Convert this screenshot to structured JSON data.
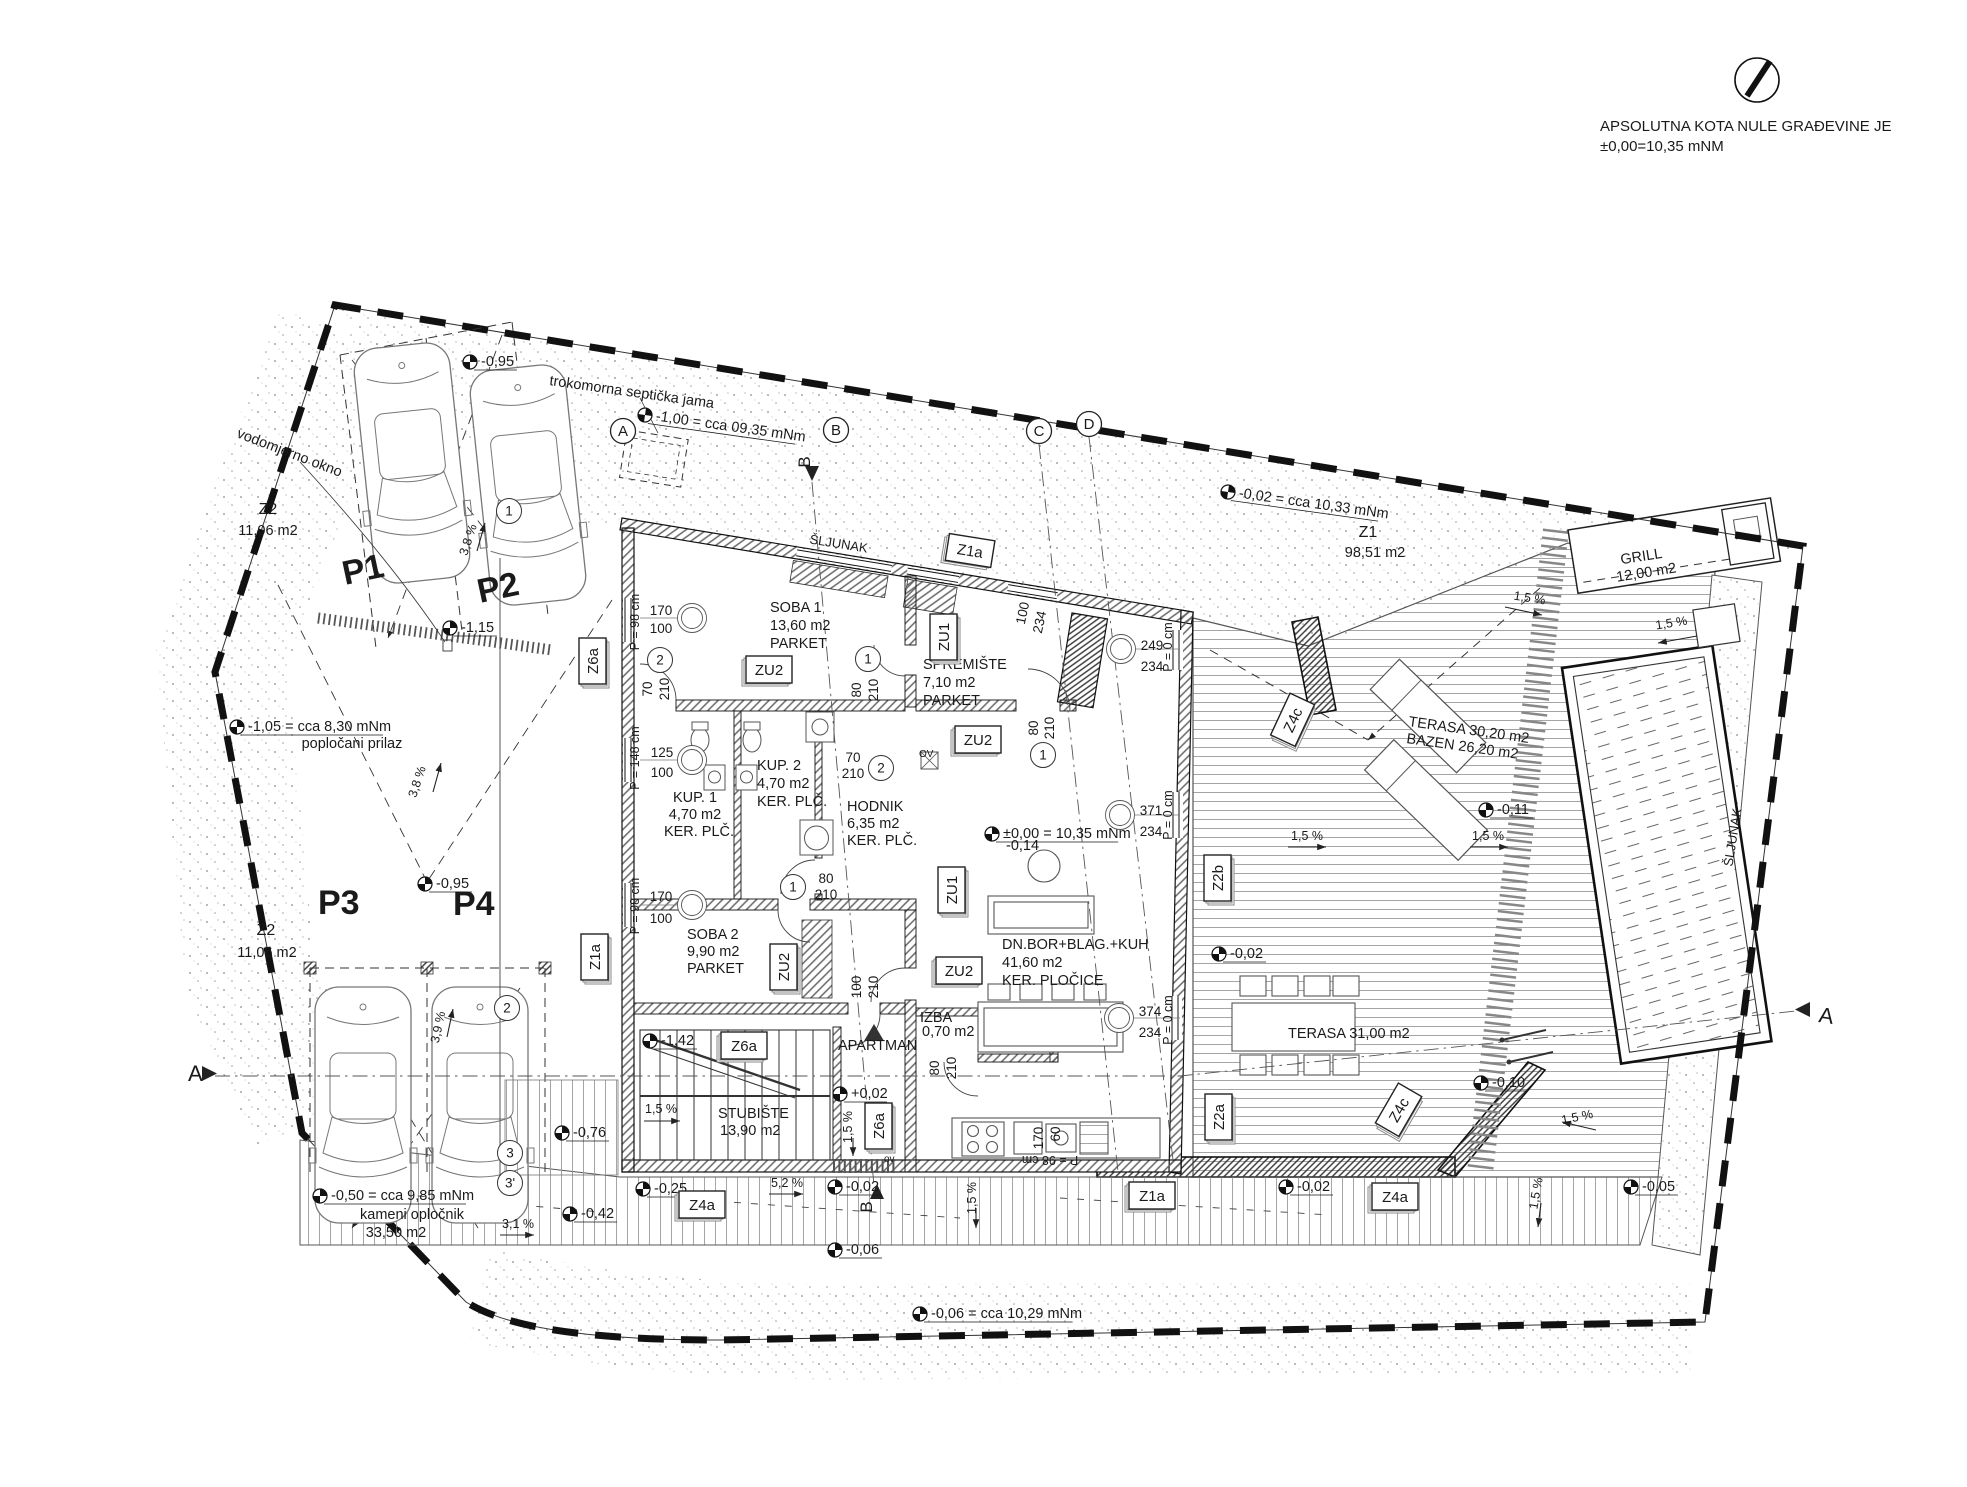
{
  "header": {
    "line1": "APSOLUTNA KOTA NULE GRAĐEVINE JE",
    "line2": "±0,00=10,35 mNM"
  },
  "labels": [
    {
      "t": "trokomorna septička jama",
      "x": 549,
      "y": 385,
      "r": 8
    },
    {
      "t": "vodomjerno okno",
      "x": 236,
      "y": 437,
      "r": 21
    },
    {
      "t": "Z2",
      "x": 268,
      "y": 514,
      "a": "m",
      "s": 16
    },
    {
      "t": "11,06 m2",
      "x": 268,
      "y": 535,
      "a": "m"
    },
    {
      "t": "Z2",
      "x": 266,
      "y": 935,
      "a": "m",
      "s": 16
    },
    {
      "t": "11,06 m2",
      "x": 267,
      "y": 957,
      "a": "m"
    },
    {
      "t": "Z1",
      "x": 1368,
      "y": 537,
      "a": "m",
      "s": 16
    },
    {
      "t": "98,51 m2",
      "x": 1375,
      "y": 557,
      "a": "m"
    },
    {
      "t": "popločani prilaz",
      "x": 352,
      "y": 748,
      "a": "m"
    },
    {
      "t": "kameni opločnik",
      "x": 412,
      "y": 1219,
      "a": "m"
    },
    {
      "t": "33,50 m2",
      "x": 396,
      "y": 1237,
      "a": "m"
    },
    {
      "t": "P1",
      "x": 345,
      "y": 585,
      "r": -12,
      "s": 34,
      "w": "b",
      "c": "#b4b4b4"
    },
    {
      "t": "P2",
      "x": 480,
      "y": 603,
      "r": -12,
      "s": 34,
      "w": "b",
      "c": "#b4b4b4"
    },
    {
      "t": "P3",
      "x": 318,
      "y": 914,
      "s": 34,
      "w": "b",
      "c": "#b4b4b4"
    },
    {
      "t": "P4",
      "x": 453,
      "y": 915,
      "s": 34,
      "w": "b",
      "c": "#b4b4b4"
    },
    {
      "t": "ŠLJUNAK",
      "x": 838,
      "y": 548,
      "a": "m",
      "r": 9,
      "s": 13
    },
    {
      "t": "ŠLJUNAK",
      "x": 1737,
      "y": 838,
      "a": "m",
      "r": -81,
      "s": 13
    },
    {
      "t": "GRILL",
      "x": 1642,
      "y": 561,
      "a": "m",
      "r": -9
    },
    {
      "t": "12,00 m2",
      "x": 1647,
      "y": 577,
      "a": "m",
      "r": -9
    },
    {
      "t": "TERASA 30,20 m2",
      "x": 1408,
      "y": 726,
      "r": 8
    },
    {
      "t": "BAZEN 26,20 m2",
      "x": 1406,
      "y": 743,
      "r": 8
    },
    {
      "t": "TERASA 31,00 m2",
      "x": 1288,
      "y": 1038
    },
    {
      "t": "SOBA 1",
      "x": 770,
      "y": 612
    },
    {
      "t": "13,60 m2",
      "x": 770,
      "y": 630
    },
    {
      "t": "PARKET",
      "x": 770,
      "y": 648
    },
    {
      "t": "SPREMIŠTE",
      "x": 923,
      "y": 669
    },
    {
      "t": "7,10 m2",
      "x": 923,
      "y": 687
    },
    {
      "t": "PARKET",
      "x": 923,
      "y": 705
    },
    {
      "t": "KUP. 1",
      "x": 695,
      "y": 802,
      "a": "m"
    },
    {
      "t": "4,70 m2",
      "x": 695,
      "y": 819,
      "a": "m"
    },
    {
      "t": "KER. PLČ.",
      "x": 699,
      "y": 836,
      "a": "m"
    },
    {
      "t": "KUP. 2",
      "x": 757,
      "y": 770
    },
    {
      "t": "4,70 m2",
      "x": 757,
      "y": 788
    },
    {
      "t": "KER. PLČ.",
      "x": 757,
      "y": 806
    },
    {
      "t": "HODNIK",
      "x": 847,
      "y": 811
    },
    {
      "t": "6,35 m2",
      "x": 847,
      "y": 828
    },
    {
      "t": "KER. PLČ.",
      "x": 847,
      "y": 845
    },
    {
      "t": "SOBA 2",
      "x": 687,
      "y": 939
    },
    {
      "t": "9,90 m2",
      "x": 687,
      "y": 956
    },
    {
      "t": "PARKET",
      "x": 687,
      "y": 973
    },
    {
      "t": "STUBIŠTE",
      "x": 718,
      "y": 1118
    },
    {
      "t": "13,90 m2",
      "x": 720,
      "y": 1135
    },
    {
      "t": "APARTMAN",
      "x": 838,
      "y": 1050
    },
    {
      "t": "IZBA",
      "x": 920,
      "y": 1022
    },
    {
      "t": "0,70 m2",
      "x": 922,
      "y": 1036
    },
    {
      "t": "DN.BOR+BLAG.+KUH",
      "x": 1002,
      "y": 949
    },
    {
      "t": "41,60 m2",
      "x": 1002,
      "y": 967
    },
    {
      "t": "KER. PLOČICE",
      "x": 1002,
      "y": 985
    },
    {
      "t": "-0,14",
      "x": 1006,
      "y": 850
    },
    {
      "t": "OV",
      "x": 919,
      "y": 757,
      "s": 10
    },
    {
      "t": "ov",
      "x": 884,
      "y": 1162,
      "s": 10
    },
    {
      "t": "170",
      "x": 661,
      "y": 615,
      "a": "m",
      "s": 13.5
    },
    {
      "t": "100",
      "x": 661,
      "y": 633,
      "a": "m",
      "s": 13.5
    },
    {
      "t": "P = 98 cm",
      "x": 639,
      "y": 622,
      "r": -90,
      "a": "m",
      "s": 12.5
    },
    {
      "t": "125",
      "x": 662,
      "y": 757,
      "a": "m",
      "s": 13.5
    },
    {
      "t": "100",
      "x": 662,
      "y": 777,
      "a": "m",
      "s": 13.5
    },
    {
      "t": "P = 148 cm",
      "x": 639,
      "y": 758,
      "r": -90,
      "a": "m",
      "s": 12.5
    },
    {
      "t": "170",
      "x": 661,
      "y": 901,
      "a": "m",
      "s": 13.5
    },
    {
      "t": "100",
      "x": 661,
      "y": 923,
      "a": "m",
      "s": 13.5
    },
    {
      "t": "P = 98 cm",
      "x": 639,
      "y": 906,
      "r": -90,
      "a": "m",
      "s": 12.5
    },
    {
      "t": "70",
      "x": 652,
      "y": 689,
      "r": -90,
      "a": "m",
      "s": 13.5
    },
    {
      "t": "210",
      "x": 669,
      "y": 689,
      "r": -90,
      "a": "m",
      "s": 13.5
    },
    {
      "t": "80",
      "x": 861,
      "y": 690,
      "r": -90,
      "a": "m",
      "s": 13.5
    },
    {
      "t": "210",
      "x": 878,
      "y": 690,
      "r": -90,
      "a": "m",
      "s": 13.5
    },
    {
      "t": "70",
      "x": 853,
      "y": 762,
      "a": "m",
      "s": 13.5
    },
    {
      "t": "210",
      "x": 853,
      "y": 778,
      "a": "m",
      "s": 13.5
    },
    {
      "t": "80",
      "x": 826,
      "y": 883,
      "a": "m",
      "s": 13.5
    },
    {
      "t": "210",
      "x": 826,
      "y": 899,
      "a": "m",
      "s": 13.5
    },
    {
      "t": "100",
      "x": 861,
      "y": 987,
      "r": -90,
      "a": "m",
      "s": 13.5
    },
    {
      "t": "210",
      "x": 878,
      "y": 987,
      "r": -90,
      "a": "m",
      "s": 13.5
    },
    {
      "t": "80",
      "x": 939,
      "y": 1068,
      "r": -90,
      "a": "m",
      "s": 13.5
    },
    {
      "t": "210",
      "x": 956,
      "y": 1068,
      "r": -90,
      "a": "m",
      "s": 13.5
    },
    {
      "t": "80",
      "x": 1038,
      "y": 728,
      "r": -90,
      "a": "m",
      "s": 13.5
    },
    {
      "t": "210",
      "x": 1054,
      "y": 728,
      "r": -90,
      "a": "m",
      "s": 13.5
    },
    {
      "t": "100",
      "x": 1027,
      "y": 614,
      "r": -78,
      "a": "m",
      "s": 13.5
    },
    {
      "t": "234",
      "x": 1044,
      "y": 623,
      "r": -78,
      "a": "m",
      "s": 13.5
    },
    {
      "t": "249",
      "x": 1152,
      "y": 650,
      "a": "m",
      "s": 13.5
    },
    {
      "t": "234",
      "x": 1152,
      "y": 671,
      "a": "m",
      "s": 13.5
    },
    {
      "t": "P = 0 cm",
      "x": 1172,
      "y": 647,
      "r": -90,
      "a": "m",
      "s": 12.5
    },
    {
      "t": "371",
      "x": 1151,
      "y": 815,
      "a": "m",
      "s": 13.5
    },
    {
      "t": "234",
      "x": 1151,
      "y": 836,
      "a": "m",
      "s": 13.5
    },
    {
      "t": "P = 0 cm",
      "x": 1172,
      "y": 815,
      "r": -90,
      "a": "m",
      "s": 12.5
    },
    {
      "t": "374",
      "x": 1150,
      "y": 1016,
      "a": "m",
      "s": 13.5
    },
    {
      "t": "234",
      "x": 1150,
      "y": 1037,
      "a": "m",
      "s": 13.5
    },
    {
      "t": "P = 0 cm",
      "x": 1172,
      "y": 1020,
      "r": -90,
      "a": "m",
      "s": 12.5
    },
    {
      "t": "170",
      "x": 1043,
      "y": 1138,
      "r": -90,
      "a": "m",
      "s": 13.5
    },
    {
      "t": "60",
      "x": 1060,
      "y": 1134,
      "r": -90,
      "a": "m",
      "s": 13.5
    },
    {
      "t": "P = 98 cm",
      "x": 1050,
      "y": 1156,
      "r": 180,
      "a": "m",
      "s": 12.5
    },
    {
      "t": "3,8 %",
      "x": 472,
      "y": 541,
      "r": -72,
      "a": "m",
      "s": 12.5
    },
    {
      "t": "3,8 %",
      "x": 421,
      "y": 783,
      "r": -72,
      "a": "m",
      "s": 12.5
    },
    {
      "t": "3,9 %",
      "x": 442,
      "y": 1028,
      "r": -78,
      "a": "m",
      "s": 12.5
    },
    {
      "t": "1,5 %",
      "x": 1529,
      "y": 602,
      "r": 9,
      "a": "m",
      "s": 12.5
    },
    {
      "t": "1,5 %",
      "x": 1672,
      "y": 627,
      "r": -9,
      "a": "m",
      "s": 12.5
    },
    {
      "t": "1,5 %",
      "x": 1307,
      "y": 840,
      "a": "m",
      "s": 12.5
    },
    {
      "t": "1,5 %",
      "x": 1488,
      "y": 840,
      "a": "m",
      "s": 12.5
    },
    {
      "t": "1,5 %",
      "x": 661,
      "y": 1113,
      "a": "m",
      "s": 12.5
    },
    {
      "t": "1,5 %",
      "x": 852,
      "y": 1127,
      "r": -90,
      "a": "m",
      "s": 12.5
    },
    {
      "t": "1,5 %",
      "x": 976,
      "y": 1198,
      "r": -90,
      "a": "m",
      "s": 12.5
    },
    {
      "t": "1,5 %",
      "x": 1540,
      "y": 1194,
      "r": -80,
      "a": "m",
      "s": 12.5
    },
    {
      "t": "1,5 %",
      "x": 1578,
      "y": 1121,
      "r": -12,
      "a": "m",
      "s": 12.5
    },
    {
      "t": "3,1 %",
      "x": 518,
      "y": 1228,
      "a": "m",
      "s": 12.5
    },
    {
      "t": "5,2 %",
      "x": 787,
      "y": 1187,
      "a": "m",
      "s": 12.5
    },
    {
      "t": "A",
      "x": 188,
      "y": 1081,
      "s": 22
    },
    {
      "t": "A",
      "x": 1818,
      "y": 1022,
      "s": 22,
      "r": 8
    },
    {
      "t": "B",
      "x": 810,
      "y": 462,
      "r": -90,
      "s": 17,
      "a": "m"
    },
    {
      "t": "B",
      "x": 872,
      "y": 1207,
      "r": -90,
      "s": 17,
      "a": "m"
    }
  ],
  "elevations": [
    {
      "t": "-0,95",
      "x": 470,
      "y": 362
    },
    {
      "t": "-1,00 = cca 09,35 mNm",
      "x": 645,
      "y": 415,
      "r": 8
    },
    {
      "t": "-1,15",
      "x": 450,
      "y": 628
    },
    {
      "t": "-1,05 = cca 8,30 mNm",
      "x": 237,
      "y": 727
    },
    {
      "t": "-0,95",
      "x": 425,
      "y": 884
    },
    {
      "t": "-0,02 = cca 10,33 mNm",
      "x": 1228,
      "y": 492,
      "r": 8
    },
    {
      "t": "±0,00 = 10,35 mNm",
      "x": 992,
      "y": 834
    },
    {
      "t": "-0,02",
      "x": 1219,
      "y": 954
    },
    {
      "t": "-0,11",
      "x": 1486,
      "y": 810
    },
    {
      "t": "-1,42",
      "x": 650,
      "y": 1041
    },
    {
      "t": "+0,02",
      "x": 840,
      "y": 1094
    },
    {
      "t": "-0,76",
      "x": 562,
      "y": 1133
    },
    {
      "t": "-0,50 = cca 9,85 mNm",
      "x": 320,
      "y": 1196
    },
    {
      "t": "-0,42",
      "x": 570,
      "y": 1214
    },
    {
      "t": "-0,25",
      "x": 643,
      "y": 1189
    },
    {
      "t": "-0,02",
      "x": 835,
      "y": 1187
    },
    {
      "t": "-0,02",
      "x": 1286,
      "y": 1187
    },
    {
      "t": "-0,06",
      "x": 835,
      "y": 1250
    },
    {
      "t": "-0,06 = cca 10,29 mNm",
      "x": 920,
      "y": 1314
    },
    {
      "t": "-0,10",
      "x": 1481,
      "y": 1083
    },
    {
      "t": "-0,05",
      "x": 1631,
      "y": 1187
    }
  ],
  "tags": [
    {
      "t": "Z1a",
      "x": 970,
      "y": 551,
      "r": 9
    },
    {
      "t": "Z6a",
      "x": 593,
      "y": 661,
      "r": -90
    },
    {
      "t": "Z1a",
      "x": 595,
      "y": 957,
      "r": -90
    },
    {
      "t": "ZU2",
      "x": 769,
      "y": 670
    },
    {
      "t": "ZU1",
      "x": 944,
      "y": 637,
      "r": -90
    },
    {
      "t": "ZU2",
      "x": 978,
      "y": 740
    },
    {
      "t": "ZU1",
      "x": 952,
      "y": 890,
      "r": -90
    },
    {
      "t": "ZU2",
      "x": 784,
      "y": 967,
      "r": -90
    },
    {
      "t": "ZU2",
      "x": 959,
      "y": 971
    },
    {
      "t": "Z6a",
      "x": 744,
      "y": 1046
    },
    {
      "t": "Z6a",
      "x": 879,
      "y": 1126,
      "r": -90
    },
    {
      "t": "Z4a",
      "x": 702,
      "y": 1205
    },
    {
      "t": "Z1a",
      "x": 1152,
      "y": 1196
    },
    {
      "t": "Z2b",
      "x": 1218,
      "y": 878,
      "r": -90
    },
    {
      "t": "Z2a",
      "x": 1219,
      "y": 1117,
      "r": -90
    },
    {
      "t": "Z4c",
      "x": 1293,
      "y": 720,
      "r": -65
    },
    {
      "t": "Z4c",
      "x": 1399,
      "y": 1110,
      "r": -60
    },
    {
      "t": "Z4a",
      "x": 1395,
      "y": 1197
    }
  ],
  "sections": [
    {
      "t": "A",
      "x": 623,
      "y": 431
    },
    {
      "t": "B",
      "x": 836,
      "y": 430
    },
    {
      "t": "C",
      "x": 1039,
      "y": 431
    },
    {
      "t": "D",
      "x": 1089,
      "y": 424
    }
  ],
  "markers": [
    {
      "t": "1",
      "x": 509,
      "y": 511
    },
    {
      "t": "2",
      "x": 507,
      "y": 1008
    },
    {
      "t": "3",
      "x": 510,
      "y": 1153
    },
    {
      "t": "3'",
      "x": 510,
      "y": 1183
    },
    {
      "t": "2",
      "x": 660,
      "y": 660
    },
    {
      "t": "1",
      "x": 868,
      "y": 659
    },
    {
      "t": "2",
      "x": 881,
      "y": 768
    },
    {
      "t": "1",
      "x": 1043,
      "y": 755
    },
    {
      "t": "1",
      "x": 793,
      "y": 887
    }
  ],
  "axes": [
    {
      "x": 692,
      "y": 618
    },
    {
      "x": 692,
      "y": 760
    },
    {
      "x": 692,
      "y": 905
    },
    {
      "x": 1121,
      "y": 649
    },
    {
      "x": 1120,
      "y": 815
    },
    {
      "x": 1119,
      "y": 1018
    }
  ]
}
